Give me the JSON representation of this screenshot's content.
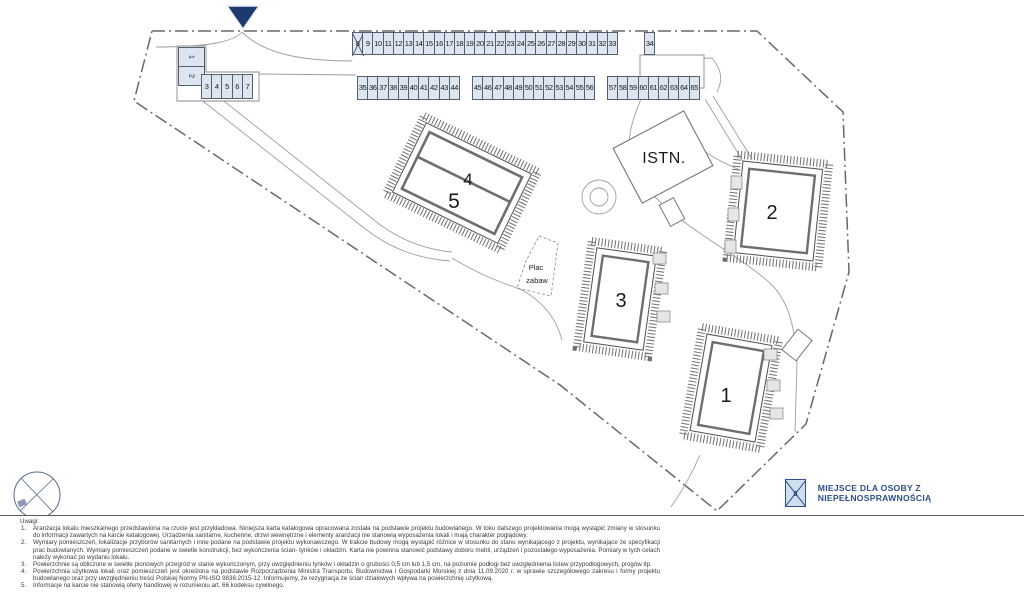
{
  "plan": {
    "labels": {
      "b1": "1",
      "b2": "2",
      "b3": "3",
      "b4": "4",
      "b5": "5",
      "istn": "ISTN."
    },
    "playground": {
      "line1": "Plac",
      "line2": "zabaw"
    },
    "icons": {
      "entrance": "down-triangle-marker",
      "compass": "compass-rose"
    }
  },
  "parking": {
    "disabled_spots": [
      8
    ],
    "groups": [
      {
        "id": "row-left-vertical",
        "spots": [
          1,
          2
        ]
      },
      {
        "id": "row-left",
        "spots": [
          3,
          4,
          5,
          6,
          7
        ]
      },
      {
        "id": "row-top-a",
        "spots": [
          8,
          9,
          10,
          11,
          12,
          13,
          14,
          15,
          16,
          17,
          18,
          19,
          20,
          21,
          22,
          23,
          24,
          25,
          26,
          27,
          28,
          29,
          30,
          31,
          32,
          33
        ]
      },
      {
        "id": "row-top-b",
        "spots": [
          34
        ]
      },
      {
        "id": "row-mid-a",
        "spots": [
          35,
          36,
          37,
          38,
          39,
          40,
          41,
          42,
          43,
          44
        ]
      },
      {
        "id": "row-mid-b",
        "spots": [
          45,
          46,
          47,
          48,
          49,
          50,
          51,
          52,
          53,
          54,
          55,
          56
        ]
      },
      {
        "id": "row-mid-c",
        "spots": [
          57,
          58,
          59,
          60,
          61,
          62,
          63,
          64,
          65
        ]
      }
    ]
  },
  "legend": {
    "icon_number": "8",
    "label": "MIEJSCE DLA OSOBY Z NIEPEŁNOSPRAWNOŚCIĄ"
  },
  "notes": {
    "title": "Uwagi:",
    "items": [
      "Aranżacja lokalu mieszkalnego przedstawiona na rzucie jest przykładowa. Niniejsza karta katalogowa opracowana została na podstawie projektu budowlanego. W toku dalszego projektowania mogą wystąpić zmiany w stosunku do informacji zawartych na karcie katalogowej. Urządzenia sanitarne, kuchenne, drzwi wewnętrzne i elementy aranżacji nie stanowią wyposażenia lokali i mają charakter poglądowy.",
      "Wymiary pomieszczeń, lokalizacje przyborów sanitarnych i inne podane na podstawie projektu wykonawczego. W trakcie budowy mogą wystąpić różnice w stosunku do stanu wynikającego z projektu, wynikające ze specyfikacji prac budowlanych. Wymiary pomieszczeń podane w świetle konstrukcji, bez wykończenia ścian- tynków i okładzin. Karta nie powinna stanowić podstawy doboru mebli, urządzeń i pozostałego wyposażenia. Pomiary w tych celach należy wykonać po wydaniu lokalu.",
      "Powierzchnie są obliczone w świetle pionowych przegród w stanie wykończonym, przy uwzględnieniu tynków i okładzin o grubości 0,5 cm lub 1,5 cm, na poziomie podłogi bez uwzględnienia listew przypodłogowych, progów itp.",
      "Powierzchnia użytkowa lokali oraz pomieszczeń jest określona na podstawie Rozporządzenia Ministra Transportu, Budownictwa i Gospodarki Morskiej z dnia 11.09.2020 r. w sprawie szczegółowego zakresu i formy projektu budowlanego oraz przy uwzględnieniu treści Polskiej Normy PN-ISO 9836:2015-12. Informujemy, że rezygnacja ze ścian działowych wpływa na powierzchnię użytkową.",
      "Informacje na karcie nie stanowią oferty handlowej w rozumieniu art. 66 kodeksu cywilnego."
    ]
  }
}
